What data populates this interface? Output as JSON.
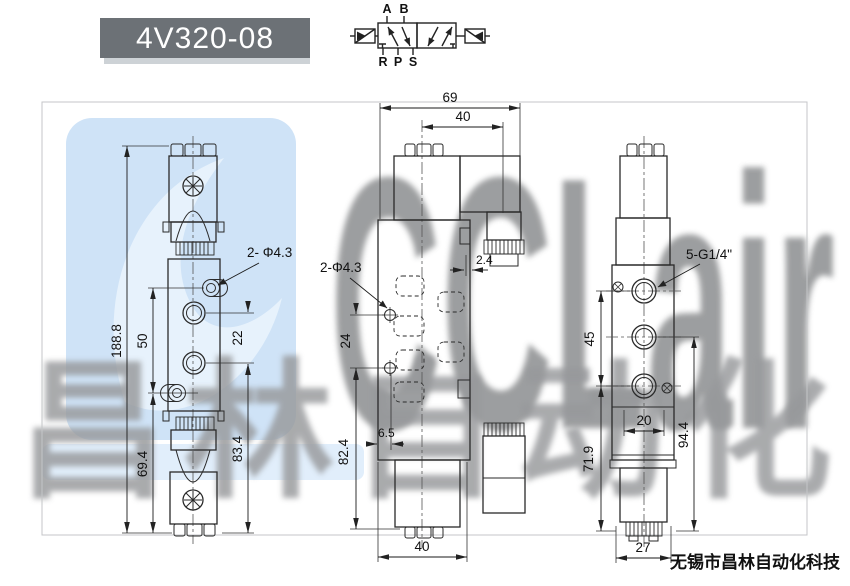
{
  "title": {
    "model": "4V320-08"
  },
  "schematic": {
    "ports_top": [
      "A",
      "B"
    ],
    "ports_bottom": [
      "R",
      "P",
      "S"
    ]
  },
  "watermark": {
    "brand": "CCLair",
    "chinese": "昌林自动化"
  },
  "footer": {
    "company": "无锡市昌林自动化科技"
  },
  "front_view": {
    "dim_total_height": "188.8",
    "dim_hole_spacing": "50",
    "dim_port_spacing": "22",
    "dim_lower_height": "69.4",
    "dim_port_to_base": "83.4",
    "label_mount_holes": "2- Φ4.3"
  },
  "side_view": {
    "dim_overall_depth": "69",
    "dim_center_to_coil": "40",
    "dim_step": "2.4",
    "label_mount_holes": "2-Φ4.3",
    "dim_hole_spacing": "24",
    "dim_edge_to_hole": "6.5",
    "dim_body_height": "82.4",
    "dim_base_depth": "40"
  },
  "end_view": {
    "label_ports": "5-G1/4\"",
    "dim_port_span": "45",
    "dim_port_width": "20",
    "dim_lower_total": "94.4",
    "dim_lower_height": "71.9",
    "dim_base_width": "27"
  },
  "colors": {
    "title_bg": "#6c7176",
    "watermark_blue": "#cfe3f7",
    "watermark_gray": "#8f9193"
  }
}
